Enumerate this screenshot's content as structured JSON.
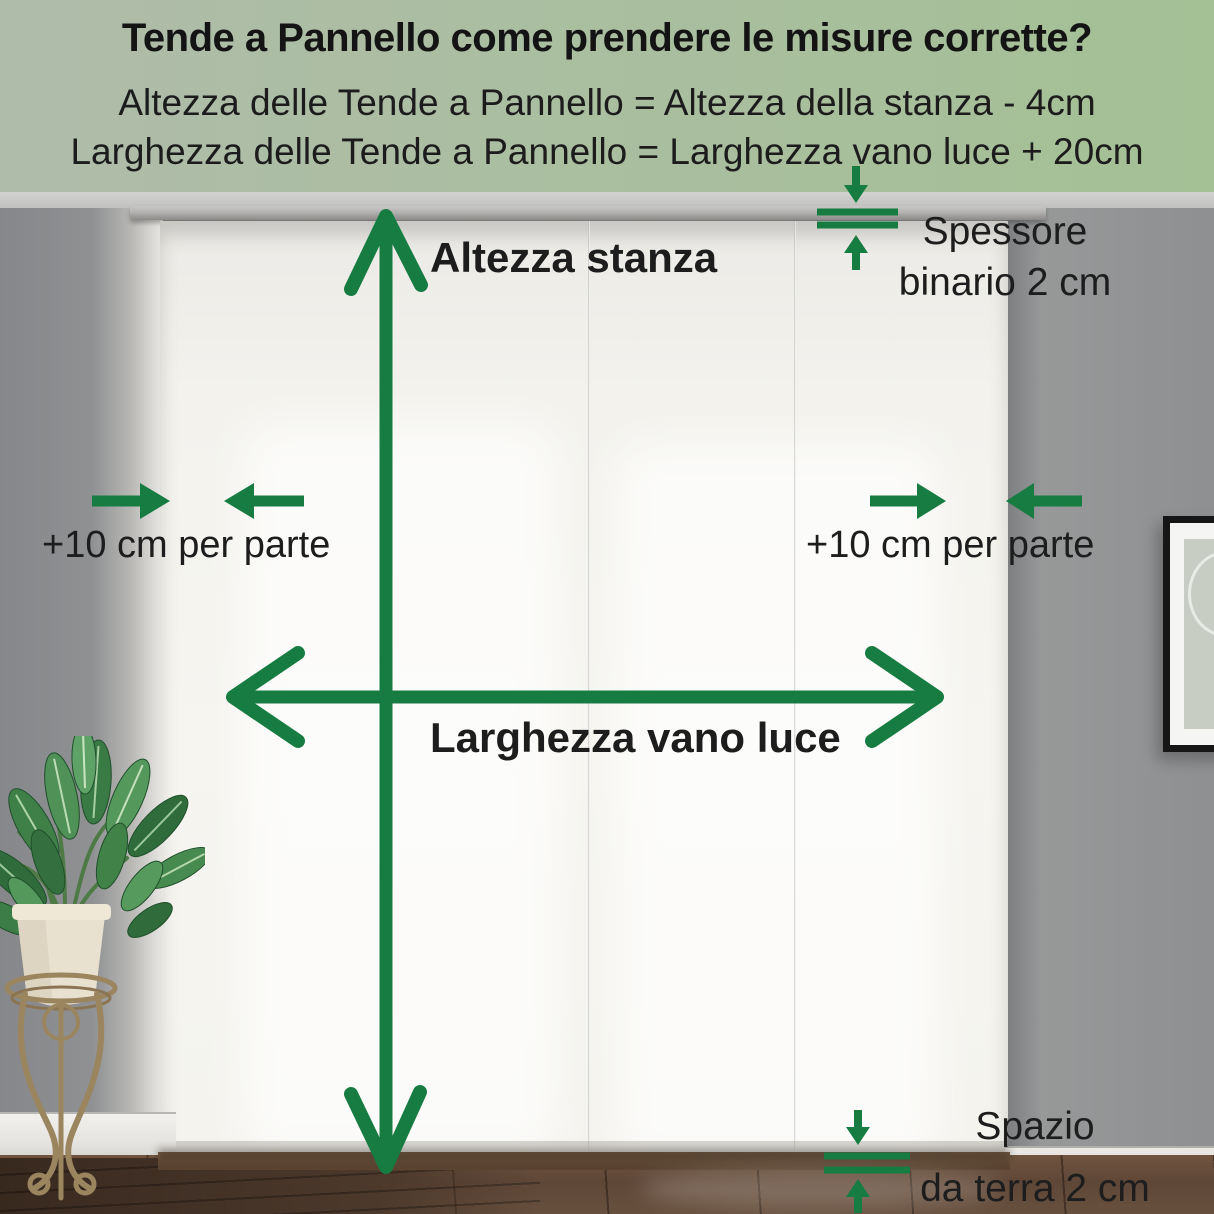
{
  "header": {
    "title": "Tende a Pannello come prendere le misure corrette?",
    "formula_height": "Altezza delle Tende a Pannello = Altezza della stanza - 4cm",
    "formula_width": "Larghezza delle Tende a Pannello = Larghezza vano luce + 20cm"
  },
  "annotations": {
    "room_height": "Altezza stanza",
    "opening_width": "Larghezza vano luce",
    "side_margin_left": "+10 cm per parte",
    "side_margin_right": "+10 cm per parte",
    "track_thickness_line1": "Spessore",
    "track_thickness_line2": "binario 2 cm",
    "floor_gap_line1": "Spazio",
    "floor_gap_line2": "da terra 2 cm"
  },
  "colors": {
    "arrow_green": "#177C41",
    "header_bg_left": "#AFBCAA",
    "header_bg_right": "#A4C095",
    "text_dark": "#1B1B1B"
  }
}
